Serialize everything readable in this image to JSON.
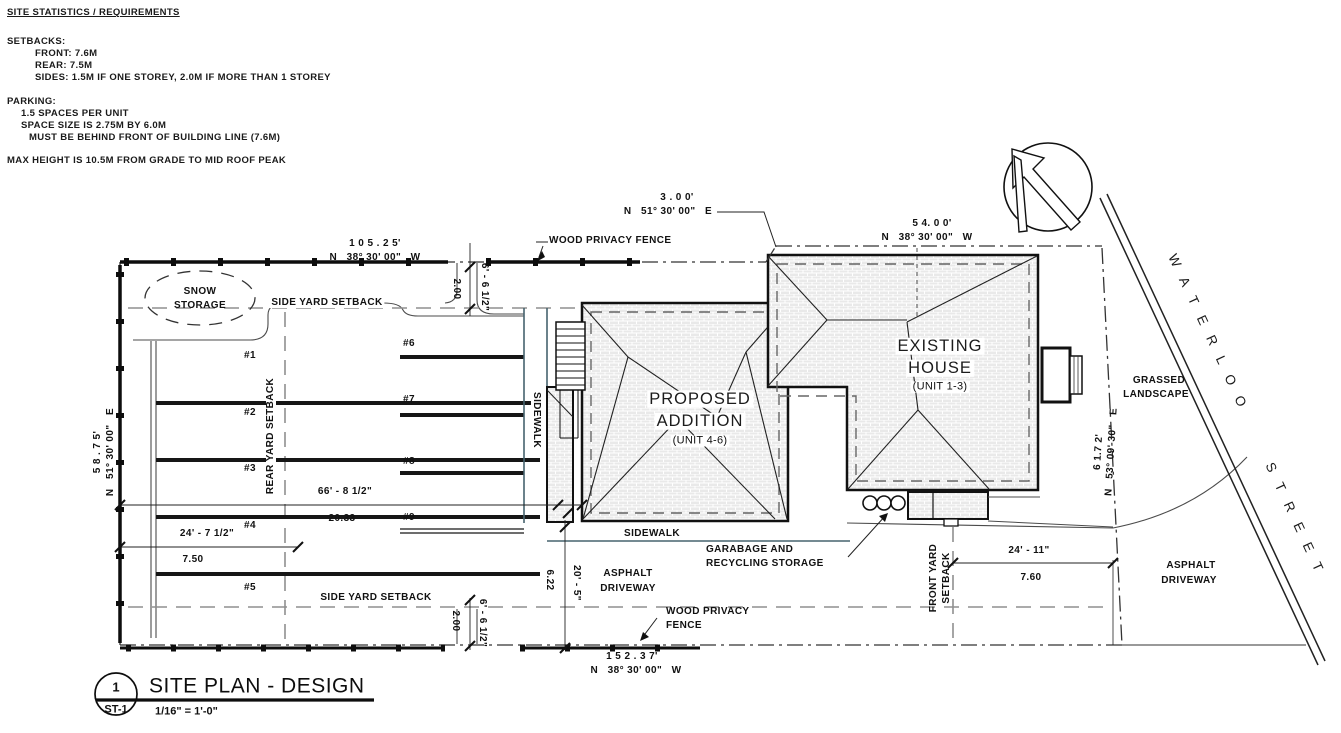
{
  "site_statistics": {
    "title": "SITE STATISTICS / REQUIREMENTS",
    "setbacks_heading": "SETBACKS:",
    "setback_front": "FRONT: 7.6M",
    "setback_rear": "REAR: 7.5M",
    "setback_sides": "SIDES: 1.5M IF ONE STOREY, 2.0M IF MORE THAN 1 STOREY",
    "parking_heading": "PARKING:",
    "parking_ratio": "1.5 SPACES PER UNIT",
    "parking_size": "SPACE SIZE IS 2.75M BY 6.0M",
    "parking_location": "MUST BE BEHIND FRONT OF BUILDING LINE (7.6M)",
    "max_height": "MAX HEIGHT IS 10.5M FROM GRADE TO MID ROOF PEAK"
  },
  "street": {
    "name": "WATERLOO   STREET"
  },
  "buildings": {
    "existing": {
      "name_line1": "EXISTING",
      "name_line2": "HOUSE",
      "unit": "(UNIT 1-3)"
    },
    "proposed": {
      "name_line1": "PROPOSED",
      "name_line2": "ADDITION",
      "unit": "(UNIT 4-6)"
    }
  },
  "labels": {
    "snow_line1": "SNOW",
    "snow_line2": "STORAGE",
    "side_yard_top": "SIDE YARD SETBACK",
    "side_yard_bottom": "SIDE YARD SETBACK",
    "rear_yard": "REAR YARD SETBACK",
    "front_yard_line1": "FRONT YARD",
    "front_yard_line2": "SETBACK",
    "sidewalk_vertical": "SIDEWALK",
    "sidewalk_horizontal": "SIDEWALK",
    "wood_fence_top": "WOOD PRIVACY FENCE",
    "wood_fence_bottom_line1": "WOOD PRIVACY",
    "wood_fence_bottom_line2": "FENCE",
    "garbage_line1": "GARABAGE AND",
    "garbage_line2": "RECYCLING STORAGE",
    "grassed_line1": "GRASSED",
    "grassed_line2": "LANDSCAPE",
    "asphalt_left_line1": "ASPHALT",
    "asphalt_left_line2": "DRIVEWAY",
    "asphalt_right_line1": "ASPHALT",
    "asphalt_right_line2": "DRIVEWAY"
  },
  "stalls": [
    "#1",
    "#2",
    "#3",
    "#4",
    "#5",
    "#6",
    "#7",
    "#8",
    "#9"
  ],
  "dimensions": {
    "rear_property_ft": "1 0 5 . 2 5'",
    "rear_property_bearing": "N   38° 30' 00\"   W",
    "jog_ft": "3 . 0 0'",
    "jog_bearing": "N   51° 30' 00\"   E",
    "house_property_ft": "5 4. 0 0'",
    "house_property_bearing": "N   38° 30' 00\"   W",
    "left_property_ft": "5 8 . 7 5'",
    "left_property_bearing": "N   51° 30' 00\"   E",
    "front_property_ft": "6 1.7 2'",
    "front_property_bearing": "N   53° 09' 30\"   E",
    "bottom_property_ft": "1 5 2 . 3 7'",
    "bottom_property_bearing": "N   38° 30' 00\"   W",
    "top_gap_ft": "6' - 6 1/2\"",
    "top_gap_m": "2.00",
    "bottom_gap_ft": "6' - 6 1/2\"",
    "bottom_gap_m": "2.00",
    "lot_depth_ft": "66' - 8 1/2\"",
    "lot_depth_m": "20.33",
    "stall_length_ft": "24' - 7 1/2\"",
    "stall_length_m": "7.50",
    "driveway_ft": "20' - 5\"",
    "driveway_m": "6.22",
    "front_driveway_ft": "24' - 11\"",
    "front_driveway_m": "7.60"
  },
  "title_block": {
    "detail_number": "1",
    "sheet_number": "ST-1",
    "title": "SITE PLAN - DESIGN",
    "scale": "1/16\" = 1'-0\""
  }
}
